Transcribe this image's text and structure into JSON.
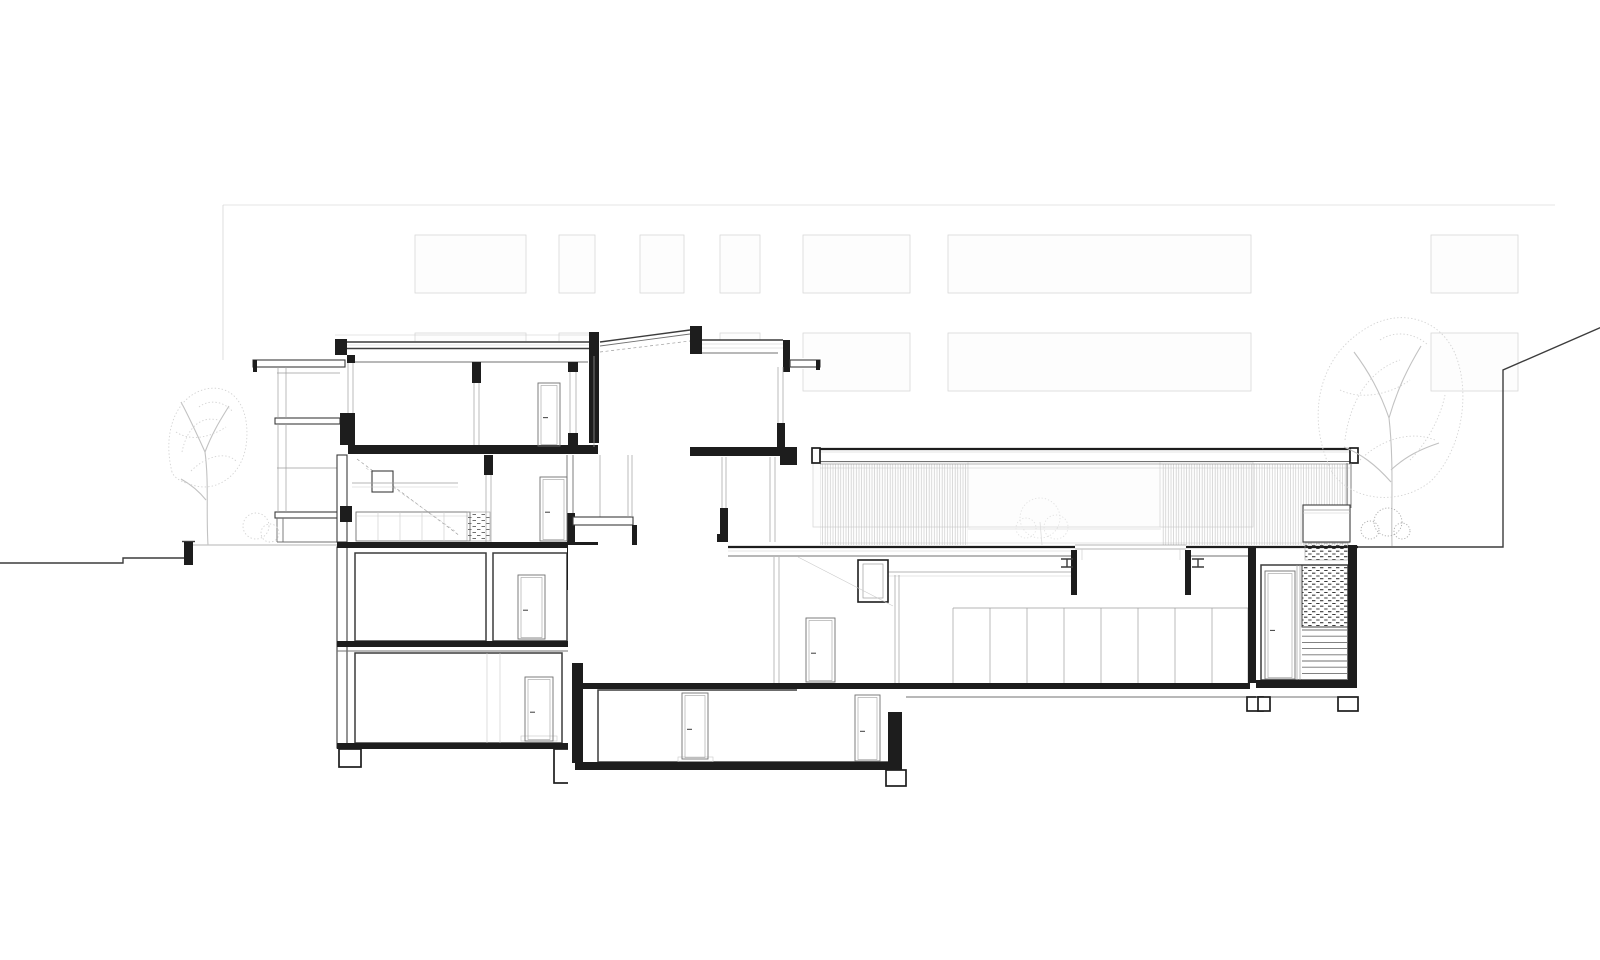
{
  "meta": {
    "title": "Architectural building section",
    "description": "Black-and-white architectural cross-section drawing: multi-storey building with balconies, central stair core with clerestory roof, sunken glazed hall to the right, faint background facade with window rows, trees left and right, sloping neighbour outline at far right."
  },
  "colors": {
    "paper": "#ffffff",
    "ink": "#1d1d1d",
    "dark": "#3c3c3c",
    "mid": "#707070",
    "light": "#9e9e9e",
    "faint": "#c9c9c9",
    "facadeLine": "#d8d8d8",
    "facadeFill": "#fdfdfd",
    "hatch": "#c4c4c4",
    "tree": "#d3d3d3",
    "treeDark": "#ababab",
    "court": "#e2e2e2"
  },
  "facade": {
    "top_y": 205,
    "left_x": 223,
    "right_x": 1555,
    "rows": [
      {
        "name": "upper-row",
        "layer": "facade",
        "y": 235,
        "h": 58,
        "windows": [
          [
            415,
            111
          ],
          [
            559,
            36
          ],
          [
            640,
            44
          ],
          [
            720,
            40
          ],
          [
            803,
            107
          ],
          [
            948,
            303
          ],
          [
            1431,
            87
          ]
        ]
      },
      {
        "name": "middle-row",
        "layer": "facade",
        "y": 333,
        "h": 58,
        "windows": [
          [
            415,
            111
          ],
          [
            559,
            36
          ],
          [
            640,
            44
          ],
          [
            720,
            40
          ],
          [
            803,
            107
          ],
          [
            948,
            303
          ],
          [
            1431,
            87
          ]
        ]
      },
      {
        "name": "hall-backwall-row",
        "layer": "hall",
        "y": 462,
        "h": 65,
        "windows": [
          [
            813,
            157
          ],
          [
            968,
            193
          ],
          [
            1160,
            93
          ]
        ]
      }
    ]
  },
  "hall": {
    "panel_top": 608,
    "panel_bottom": 683,
    "panel_xs": [
      953,
      990,
      1027,
      1064,
      1101,
      1138,
      1175,
      1212,
      1248
    ]
  },
  "stairs": {
    "upper_flight": {
      "x0": 637,
      "x1": 693,
      "y0": 546,
      "y1": 588,
      "treads": 8
    },
    "wide_steps": {
      "rise": 6,
      "lines": [
        [
          637,
          730,
          662
        ],
        [
          637,
          742,
          668
        ],
        [
          637,
          753,
          674
        ]
      ]
    },
    "right_room_treads": {
      "x0": 1302,
      "x1": 1348,
      "y0": 630,
      "rise": 6.2,
      "count": 9
    }
  },
  "doors": [
    {
      "name": "upper-floor-door",
      "x": 538,
      "y": 383,
      "w": 22,
      "h": 63
    },
    {
      "name": "ground-floor-door",
      "x": 540,
      "y": 477,
      "w": 27,
      "h": 64
    },
    {
      "name": "lower-floor-door",
      "x": 518,
      "y": 575,
      "w": 27,
      "h": 64
    },
    {
      "name": "left-basement-door",
      "x": 525,
      "y": 677,
      "w": 28,
      "h": 64
    },
    {
      "name": "mid-basement-door-left",
      "x": 682,
      "y": 693,
      "w": 26,
      "h": 66
    },
    {
      "name": "mid-basement-door-right",
      "x": 855,
      "y": 695,
      "w": 25,
      "h": 66
    },
    {
      "name": "stair-hall-door",
      "x": 806,
      "y": 618,
      "w": 29,
      "h": 64
    },
    {
      "name": "right-room-door",
      "x": 1265,
      "y": 571,
      "w": 30,
      "h": 108
    }
  ]
}
